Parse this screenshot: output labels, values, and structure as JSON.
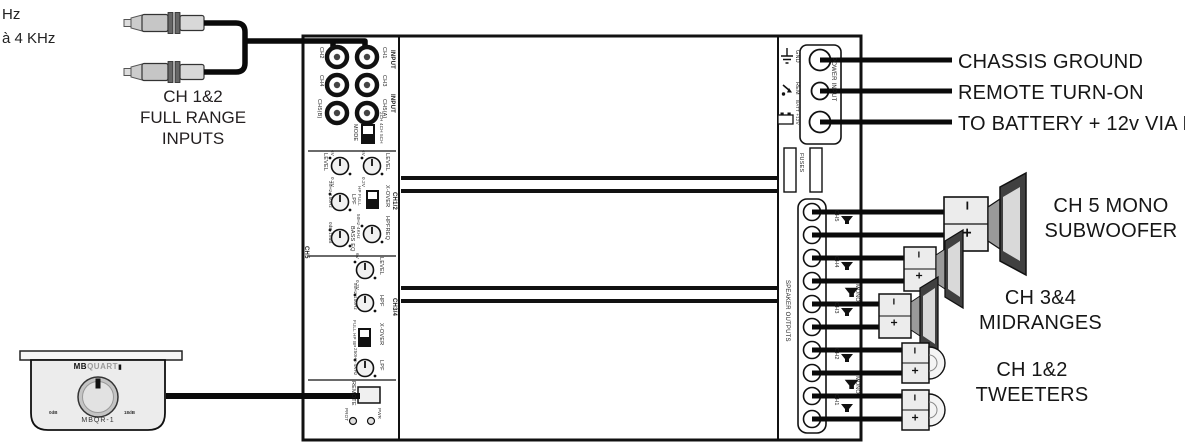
{
  "fragments": {
    "line1": "Hz",
    "line2": "à 4 KHz"
  },
  "rca": {
    "label1": "CH 1&2",
    "label2": "FULL RANGE",
    "label3": "INPUTS"
  },
  "amp": {
    "inputs": {
      "input_top": "INPUT",
      "input_mid": "INPUT",
      "left": [
        "CH2",
        "CH4",
        "CH5(B)"
      ],
      "right": [
        "CH1",
        "CH3",
        "CH5(A)"
      ]
    },
    "mode": {
      "label": "MODE",
      "options": "2CH 4CH 5CH"
    },
    "ch5": {
      "name": "CH5",
      "level": "LEVEL",
      "vmin": "0.2V",
      "vmax": "6V",
      "lpf": "LPF",
      "lpf_range": "30Hz-150Hz",
      "bass": "BASS EQ",
      "bass_range": "0dB-18dB"
    },
    "ch12": {
      "name": "CH1/2",
      "level": "LEVEL",
      "vmin": "0.2V",
      "vmax": "6V",
      "xover": "X-OVER",
      "xover_opts": "HP FULL",
      "hpfreq": "HPFREQ",
      "hpfreq_range": "50Hz-4KHz"
    },
    "ch34": {
      "name": "CH3/4",
      "level": "LEVEL",
      "vmin": "0.2V",
      "vmax": "6V",
      "hpf": "HPF",
      "hpf_range": "50Hz-150Hz",
      "xover": "X-OVER",
      "xover_opts": "FULL HP BP",
      "lpf": "LPF",
      "lpf_range": "250Hz-4KHz"
    },
    "remote_jack": "REMOTE",
    "leds": {
      "prot": "PROT",
      "pwr": "PWR"
    },
    "power": {
      "gnd": "GND",
      "rem": "REM",
      "batt": "BATT +12V",
      "panel": "POWER INPUT",
      "fuses": "FUSES"
    },
    "outputs": {
      "panel": "SPEAKER OUTPUTS",
      "ch": [
        "CH5",
        "CH4",
        "CH3",
        "CH2",
        "CH1"
      ],
      "mono_top": "MONO",
      "mono_bot": "MONO"
    }
  },
  "wiring": {
    "chassis": "CHASSIS GROUND",
    "remote_on": "REMOTE TURN-ON",
    "battery": "TO BATTERY + 12v VIA FUSE",
    "sub1": "CH 5 MONO",
    "sub2": "SUBWOOFER",
    "mid1": "CH 3&4",
    "mid2": "MIDRANGES",
    "tw1": "CH 1&2",
    "tw2": "TWEETERS",
    "minus": "−",
    "plus": "+"
  },
  "remote": {
    "brand_mb": "MB",
    "brand_quart": "QUART",
    "brand_block": "▮",
    "model": "MBQR-1",
    "dial_min": "0dB",
    "dial_max": "18dB"
  }
}
